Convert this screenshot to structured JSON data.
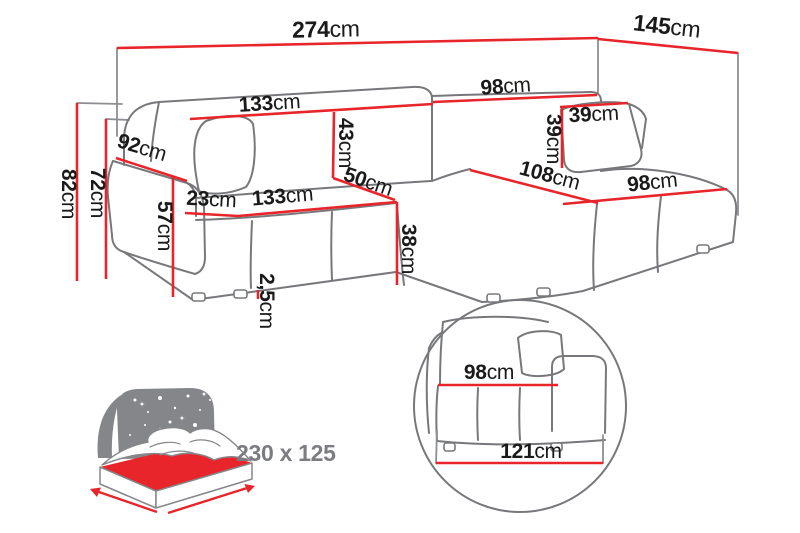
{
  "page": {
    "background": "#ffffff",
    "description": "Corner sofa bed dimension diagram with sleeping-area icon and base detail view"
  },
  "colors": {
    "dimension_line": "#e8252b",
    "outline": "#77787b",
    "text": "#1a1a1a",
    "muted_text": "#7b7c80"
  },
  "sofa_diagram": {
    "dimensions": {
      "total_width": {
        "value": "274",
        "unit": "cm"
      },
      "total_depth": {
        "value": "145",
        "unit": "cm"
      },
      "overall_height": {
        "value": "82",
        "unit": "cm"
      },
      "frame_height": {
        "value": "72",
        "unit": "cm"
      },
      "armrest_depth": {
        "value": "92",
        "unit": "cm"
      },
      "armrest_height": {
        "value": "57",
        "unit": "cm"
      },
      "armrest_width": {
        "value": "23",
        "unit": "cm"
      },
      "left_backrest_width": {
        "value": "133",
        "unit": "cm"
      },
      "right_backrest_width": {
        "value": "98",
        "unit": "cm"
      },
      "backrest_cushion_height": {
        "value": "43",
        "unit": "cm"
      },
      "seat_width": {
        "value": "133",
        "unit": "cm"
      },
      "seat_depth": {
        "value": "50",
        "unit": "cm"
      },
      "seat_front_height": {
        "value": "38",
        "unit": "cm"
      },
      "pillow_width": {
        "value": "39",
        "unit": "cm"
      },
      "pillow_height": {
        "value": "39",
        "unit": "cm"
      },
      "chaise_width": {
        "value": "108",
        "unit": "cm"
      },
      "chaise_front_width": {
        "value": "98",
        "unit": "cm"
      },
      "leg_height": {
        "value": "2,5",
        "unit": "cm"
      }
    }
  },
  "sleeping_function": {
    "icon": "bed-with-night-sky-icon",
    "area_label": "230 x 125"
  },
  "detail_view": {
    "icon": "magnified-detail-circle",
    "seat_width": {
      "value": "98",
      "unit": "cm"
    },
    "base_width": {
      "value": "121",
      "unit": "cm"
    }
  }
}
